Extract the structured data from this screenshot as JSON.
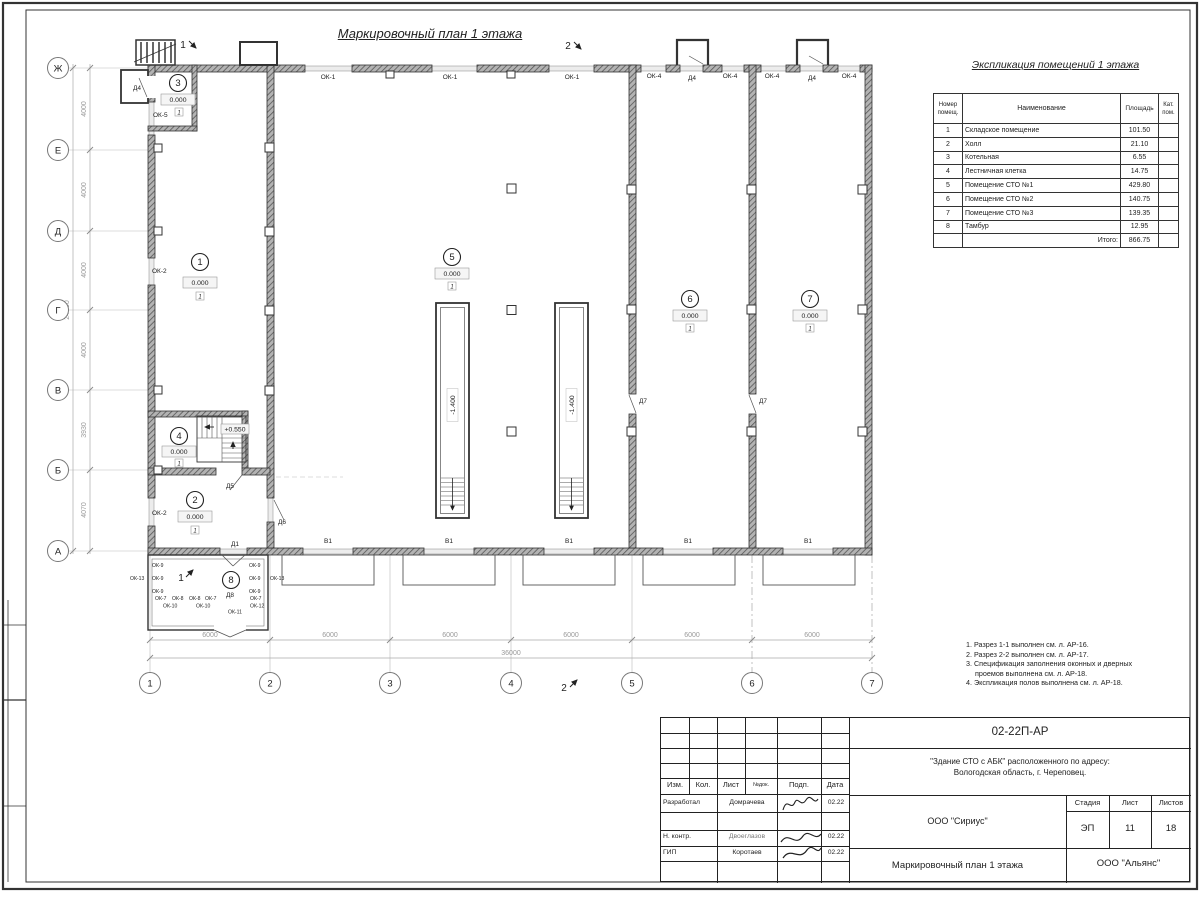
{
  "drawing_title": "Маркировочный план 1 этажа",
  "schedule": {
    "title": "Экспликация помещений 1 этажа",
    "header_num_1": "Номер",
    "header_num_2": "помещ.",
    "header_name": "Наименование",
    "header_area": "Площадь",
    "header_kat_1": "Кат.",
    "header_kat_2": "пом.",
    "rows": [
      {
        "num": "1",
        "name": "Складское помещение",
        "area": "101.50"
      },
      {
        "num": "2",
        "name": "Холл",
        "area": "21.10"
      },
      {
        "num": "3",
        "name": "Котельная",
        "area": "6.55"
      },
      {
        "num": "4",
        "name": "Лестничная клетка",
        "area": "14.75"
      },
      {
        "num": "5",
        "name": "Помещение СТО №1",
        "area": "429.80"
      },
      {
        "num": "6",
        "name": "Помещение СТО №2",
        "area": "140.75"
      },
      {
        "num": "7",
        "name": "Помещение СТО №3",
        "area": "139.35"
      },
      {
        "num": "8",
        "name": "Тамбур",
        "area": "12.95"
      }
    ],
    "total_label": "Итого:",
    "total": "866.75"
  },
  "notes": {
    "lines": [
      "1. Разрез 1-1 выполнен см. л. АР-16.",
      "2. Разрез 2-2 выполнен см. л. АР-17.",
      "3. Спецификация заполнения оконных и дверных",
      "проемов выполнена см. л. АР-18.",
      "4. Экспликация полов выполнена см. л. АР-18."
    ]
  },
  "titleblock": {
    "doc_number": "02-22П-АР",
    "project_line1": "\"Здание СТО с АБК\" расположенного по адресу:",
    "project_line2": "Вологодская область, г. Череповец.",
    "org": "ООО \"Сириус\"",
    "sheet_title": "Маркировочный план 1 этажа",
    "company": "ООО \"Альянс\"",
    "stage_label": "Стадия",
    "sheet_label": "Лист",
    "sheets_label": "Листов",
    "stage": "ЭП",
    "sheet": "11",
    "sheets": "18",
    "col_izm": "Изм.",
    "col_kol": "Кол.",
    "col_list": "Лист",
    "col_ndoc": "№док.",
    "col_podp": "Подп.",
    "col_data": "Дата",
    "roles": [
      {
        "role": "Разработал",
        "name": "Домрачева",
        "date": "02.22"
      },
      {
        "role": "Н. контр.",
        "name": "Двоеглазов",
        "date": "02.22"
      },
      {
        "role": "ГИП",
        "name": "Коротаев",
        "date": "02.22"
      }
    ]
  },
  "plan": {
    "axis_rows": [
      "Ж",
      "Е",
      "Д",
      "Г",
      "В",
      "Б",
      "А"
    ],
    "axis_cols": [
      "1",
      "2",
      "3",
      "4",
      "5",
      "6",
      "7"
    ],
    "dims_left": [
      "4000",
      "4000",
      "4000",
      "4000",
      "3930",
      "4070"
    ],
    "dim_left_total": "24000",
    "dims_bottom": [
      "6000",
      "6000",
      "6000",
      "6000",
      "6000",
      "6000"
    ],
    "dim_bottom_total": "36000",
    "rooms": [
      {
        "num": "1",
        "elev": "0.000",
        "floor": "1"
      },
      {
        "num": "2",
        "elev": "0.000",
        "floor": "1"
      },
      {
        "num": "3",
        "elev": "0.000",
        "floor": "1"
      },
      {
        "num": "4",
        "elev": "0.000",
        "floor": "1"
      },
      {
        "num": "5",
        "elev": "0.000",
        "floor": "1"
      },
      {
        "num": "6",
        "elev": "0.000",
        "floor": "1"
      },
      {
        "num": "7",
        "elev": "0.000",
        "floor": "1"
      },
      {
        "num": "8"
      }
    ],
    "stair_elev": "+0.550",
    "pit_elev": "-1.400",
    "section_1": "1",
    "section_2": "2",
    "labels": {
      "ok1": "ОК-1",
      "ok2": "ОК-2",
      "ok4": "ОК-4",
      "ok5": "ОК-5",
      "ok7": "ОК-7",
      "ok8": "ОК-8",
      "ok9": "ОК-9",
      "ok10": "ОК-10",
      "ok11": "ОК-11",
      "ok12": "ОК-12",
      "ok13": "ОК-13",
      "d1": "Д1",
      "d4": "Д4",
      "d5": "Д5",
      "d6": "Д6",
      "d7": "Д7",
      "d8": "Д8",
      "v1": "В1"
    }
  }
}
